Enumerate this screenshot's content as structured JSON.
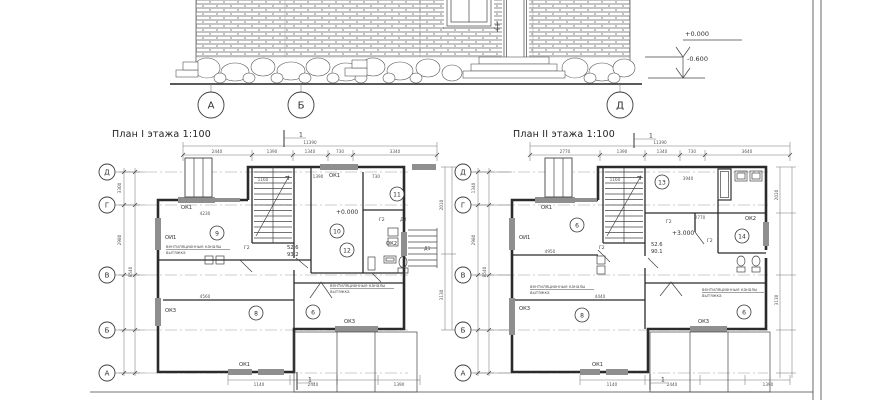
{
  "elevation": {
    "axis_labels": [
      "А",
      "Б",
      "Д"
    ],
    "levels": {
      "zero": "+0.000",
      "minus": "-0.600"
    }
  },
  "plan1": {
    "title": "План I этажа 1:100",
    "section_mark": "1",
    "axes": [
      "Д",
      "Г",
      "В",
      "Б",
      "А"
    ],
    "level": "+0.000",
    "area_top": "52.6",
    "area_bottom": "93.2",
    "rooms": [
      "9",
      "10",
      "11",
      "12",
      "8",
      "6"
    ],
    "windows": [
      "ОК1",
      "ОИ1",
      "ОК1",
      "ОК2",
      "ОК3",
      "ОК1",
      "ОК3"
    ],
    "doors": [
      "Г2",
      "Г2",
      "Д2",
      "Д1"
    ],
    "vent_note_1": [
      "вентиляционные каналы",
      "вытяжка"
    ],
    "vent_note_2": [
      "вентиляционные каналы",
      "вытяжка"
    ],
    "stair_dim": "1160",
    "dims_top": [
      "2440",
      "1390",
      "1340",
      "730",
      "3340"
    ],
    "dims_top_total": "11390",
    "dims_left": [
      "3300",
      "2980",
      "8540"
    ],
    "dims_right": [
      "2010",
      "3130"
    ],
    "dims_bottom": [
      "1140",
      "2440",
      "1390"
    ],
    "dims_inner": [
      "4230",
      "1390",
      "730",
      "4560"
    ]
  },
  "plan2": {
    "title": "План II этажа 1:100",
    "section_mark": "1",
    "axes": [
      "Д",
      "Г",
      "В",
      "Б",
      "А"
    ],
    "level": "+3.000",
    "area_top": "52.6",
    "area_bottom": "90.1",
    "rooms": [
      "6",
      "13",
      "14",
      "8",
      "6"
    ],
    "windows": [
      "ОК1",
      "ОИ1",
      "ОК2",
      "ОК3",
      "ОК1",
      "ОК3"
    ],
    "doors": [
      "Г2",
      "Г2",
      "Г2"
    ],
    "vent_note_1": [
      "вентиляционные каналы",
      "вытяжка"
    ],
    "vent_note_2": [
      "вентиляционные каналы",
      "вытяжка"
    ],
    "stair_dim": "1160",
    "dims_top": [
      "2770",
      "1390",
      "1340",
      "730",
      "3640"
    ],
    "dims_top_total": "11390",
    "dims_left": [
      "1340",
      "2980",
      "8540"
    ],
    "dims_right": [
      "2010",
      "3130"
    ],
    "dims_bottom": [
      "1140",
      "2440",
      "1390"
    ],
    "dims_inner": [
      "4950",
      "2770",
      "4440",
      "3940"
    ]
  }
}
